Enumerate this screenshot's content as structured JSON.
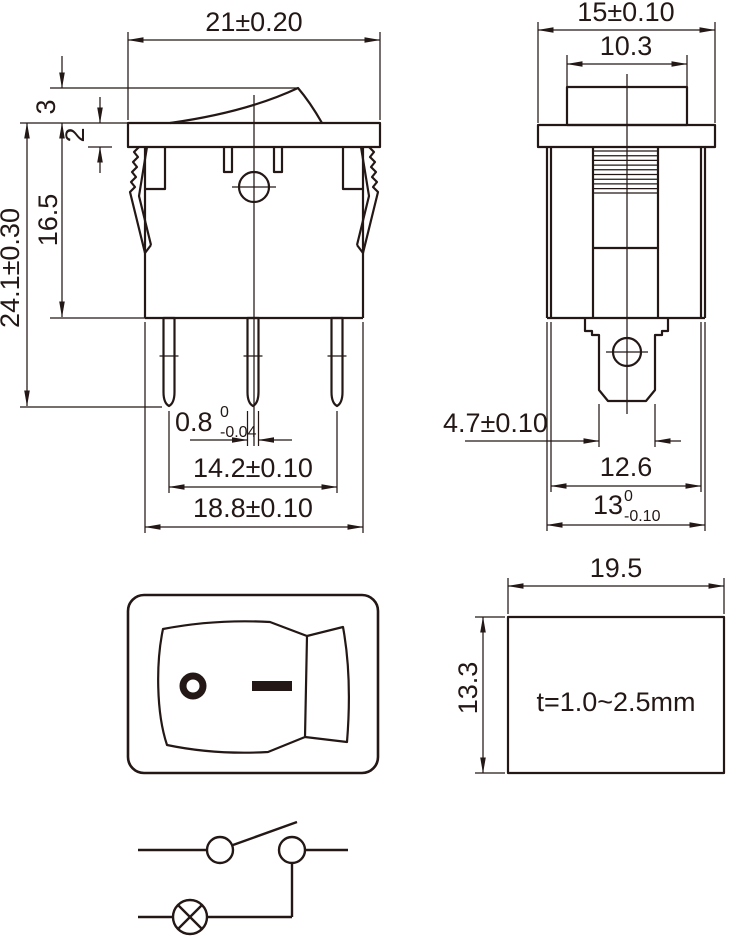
{
  "document": {
    "units": "mm"
  },
  "colors": {
    "line": "#231815",
    "background": "#ffffff"
  },
  "symbols": {
    "rocker_off": "ring-O-symbol",
    "rocker_on": "dash-symbol",
    "mounting_hole": "circle-crosshair",
    "circuit_contact": "open-circle",
    "circuit_lamp": "circle-with-x"
  },
  "views": {
    "front": {
      "dims": {
        "overall_width": "21±0.20",
        "rocker_height": "3",
        "flange_thickness": "2",
        "body_height": "16.5",
        "overall_height": "24.1±0.30",
        "terminal_thickness": {
          "value": "0.8",
          "tol_upper": "0",
          "tol_lower": "-0.04"
        },
        "terminal_pitch": "14.2±0.10",
        "body_width": "18.8±0.10"
      }
    },
    "side": {
      "dims": {
        "flange_depth": "15±0.10",
        "rocker_depth": "10.3",
        "terminal_width": "4.7±0.10",
        "body_depth": "12.6",
        "mounting_depth": {
          "value": "13",
          "tol_upper": "0",
          "tol_lower": "-0.10"
        }
      }
    },
    "panel_cutout": {
      "dims": {
        "cutout_width": "19.5",
        "cutout_height": "13.3",
        "panel_thickness": "t=1.0~2.5mm"
      }
    }
  }
}
